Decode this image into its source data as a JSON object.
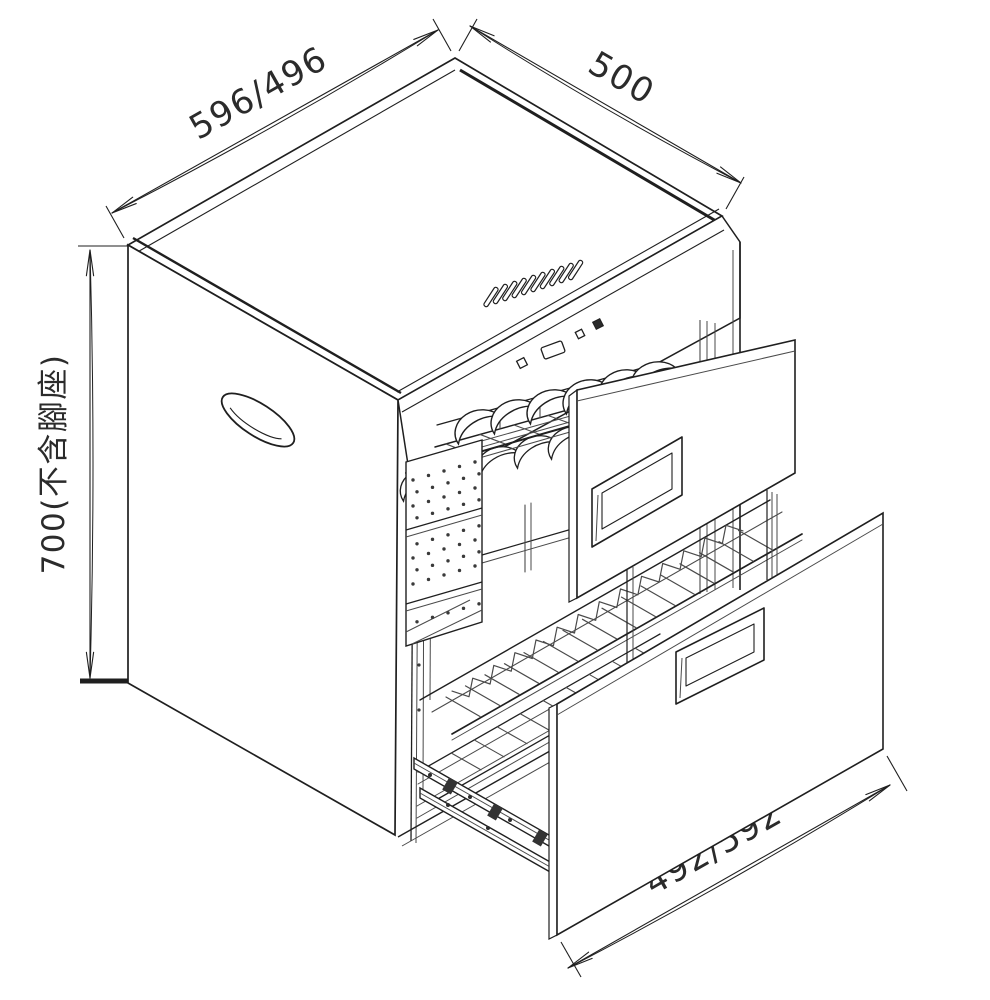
{
  "drawing": {
    "dimensions": {
      "top_width": {
        "label": "596/496"
      },
      "top_depth": {
        "label": "500"
      },
      "height": {
        "label": "700(不含腳座)"
      },
      "drawer_width": {
        "label": "492/592"
      }
    },
    "colors": {
      "line": "#1f1f1f",
      "line_soft": "#4a4a4a",
      "background": "#ffffff",
      "dot": "#3a3a3a"
    }
  }
}
